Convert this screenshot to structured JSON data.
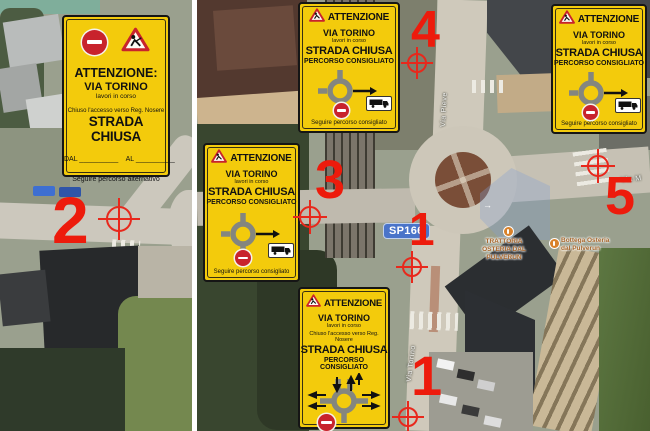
{
  "sign_main": {
    "title": "ATTENZIONE:",
    "road": "VIA TORINO",
    "works": "lavori in corso",
    "access": "Chiuso l'accesso verso Reg. Nosere",
    "closed": "STRADA CHIUSA",
    "dates": "DAL __________    AL __________",
    "footer": "Seguire percorso alternativo"
  },
  "sign_route": {
    "title": "ATTENZIONE",
    "road": "VIA TORINO",
    "works": "lavori in corso",
    "closed": "STRADA CHIUSA",
    "advice": "PERCORSO CONSIGLIATO",
    "footer": "Seguire percorso consigliato"
  },
  "sign_detour": {
    "title": "ATTENZIONE",
    "road": "VIA TORINO",
    "works": "lavori in corso",
    "access": "Chiuso l'accesso verso Reg. Nosere",
    "closed": "STRADA CHIUSA",
    "advice": "PERCORSO CONSIGLIATO"
  },
  "markers": {
    "one_mid": "1",
    "one_bottom": "1",
    "two": "2",
    "three": "3",
    "four": "4",
    "five": "5"
  },
  "map": {
    "badge": "SP166",
    "street_pieve": "Via Pieve",
    "street_torino": "Via Torino",
    "street_m": "Via M",
    "poi_trattoria": "TRATTORIA OSTERIA DAL PULVERUN",
    "poi_bottega": "Bottega Osteria dal Pulverun"
  },
  "colors": {
    "sign_yellow": "#F3CB0C",
    "marker_red": "#ED1B0C",
    "badge_blue": "#4A74C9",
    "poi_orange": "#A8672C",
    "no_entry_red": "#C8232C"
  }
}
